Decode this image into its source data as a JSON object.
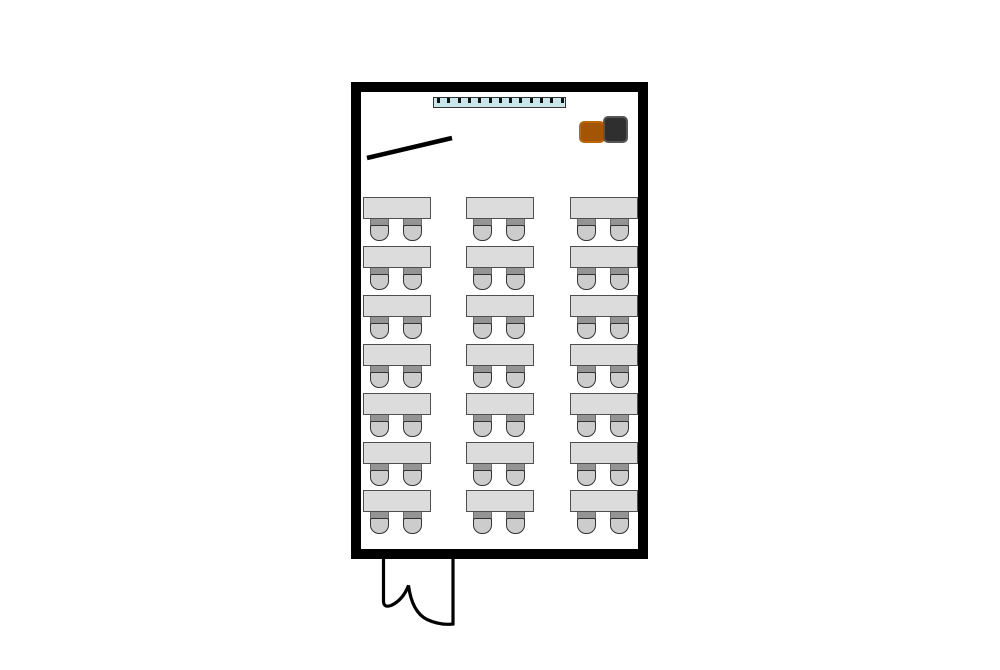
{
  "title": "Classroom floor plan",
  "canvas": {
    "width": 1000,
    "height": 670,
    "background": "#ffffff"
  },
  "room": {
    "x": 351,
    "y": 82,
    "width": 297,
    "height": 477,
    "wall_thickness": 10,
    "wall_color": "#000000",
    "floor_color": "#ffffff"
  },
  "whiteboard": {
    "x": 433,
    "y": 97,
    "width": 133,
    "height": 11,
    "fill": "#c9e6ec",
    "border_color": "#333333",
    "tick_count": 13,
    "tick_color": "#111111",
    "tick_width": 3,
    "tick_height": 5,
    "tick_spacing": 10.3,
    "tick_offset": 3
  },
  "pointer_line": {
    "x1": 367,
    "y1": 158,
    "x2": 452,
    "y2": 138,
    "color": "#000000",
    "stroke_width": 4.5
  },
  "teacher_seats": {
    "orange": {
      "x": 579,
      "y": 121,
      "width": 26,
      "height": 22,
      "fill": "#a35503",
      "border_color": "#c06600",
      "border_width": 2,
      "radius": 5
    },
    "black": {
      "x": 603,
      "y": 116,
      "width": 25,
      "height": 27,
      "fill": "#2f2f2f",
      "border_color": "#565656",
      "border_width": 2,
      "radius": 5
    }
  },
  "desk_grid": {
    "columns_x": [
      363,
      466,
      570
    ],
    "rows_y": [
      197,
      246,
      295,
      344,
      393,
      442,
      490
    ],
    "desk_count": 21,
    "seats_per_desk": 2,
    "desk": {
      "width": 68,
      "height": 22,
      "fill": "#dcdcdc",
      "border_color": "#4f4f4f",
      "border_width": 1
    },
    "chair": {
      "offsets_x": [
        7,
        40
      ],
      "width": 19,
      "back_top": 21,
      "back_height": 9,
      "back_fill": "#949494",
      "back_border": "#6a6a6a",
      "seat_top": 28,
      "seat_height": 16,
      "seat_fill": "#cccccc",
      "seat_border": "#333333",
      "seat_radius": 9
    }
  },
  "door": {
    "path": "M 383.5 558 L 383.5 601 Q 383.5 608 391 605.5 Q 403 600 408.5 585.5 Q 412 612 427 619.5 Q 440 625.5 453 624 L 453 558",
    "color": "#000000",
    "stroke_width": 3.2
  }
}
